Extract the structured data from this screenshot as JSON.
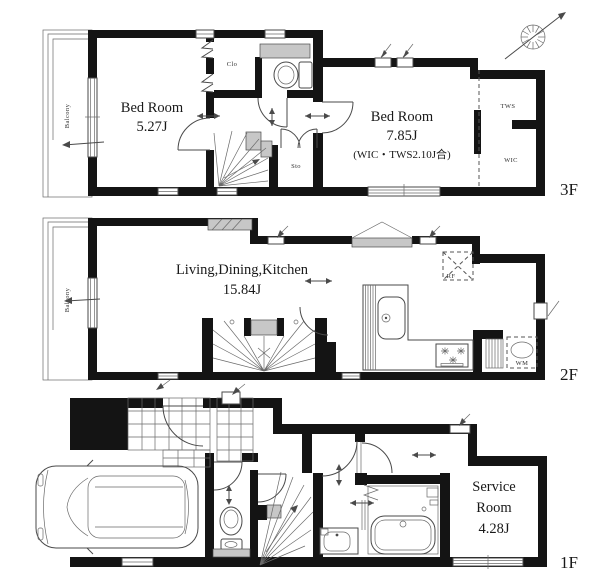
{
  "document": {
    "type": "floor-plan"
  },
  "floors": {
    "f3": {
      "floor_label": "3F",
      "bedroom_small_name": "Bed Room",
      "bedroom_small_area": "5.27J",
      "bedroom_large_name": "Bed Room",
      "bedroom_large_area": "7.85J",
      "bedroom_large_note": "(WIC・TWS2.10J合)",
      "closet_label": "Clo",
      "storage_label": "Sto",
      "tws_label": "TWS",
      "wic_label": "WIC",
      "balcony_label": "Balcony"
    },
    "f2": {
      "floor_label": "2F",
      "ldk_name": "Living,Dining,Kitchen",
      "ldk_area": "15.84J",
      "fridge_label": "RF",
      "washer_label": "WM",
      "balcony_label": "Balcony"
    },
    "f1": {
      "floor_label": "1F",
      "service_name_line1": "Service",
      "service_name_line2": "Room",
      "service_area": "4.28J"
    }
  },
  "colors": {
    "wall": "#141414",
    "thin_line": "#4a4a4a",
    "gray_fill": "#c7c7c7",
    "text": "#191919",
    "background": "#ffffff"
  }
}
